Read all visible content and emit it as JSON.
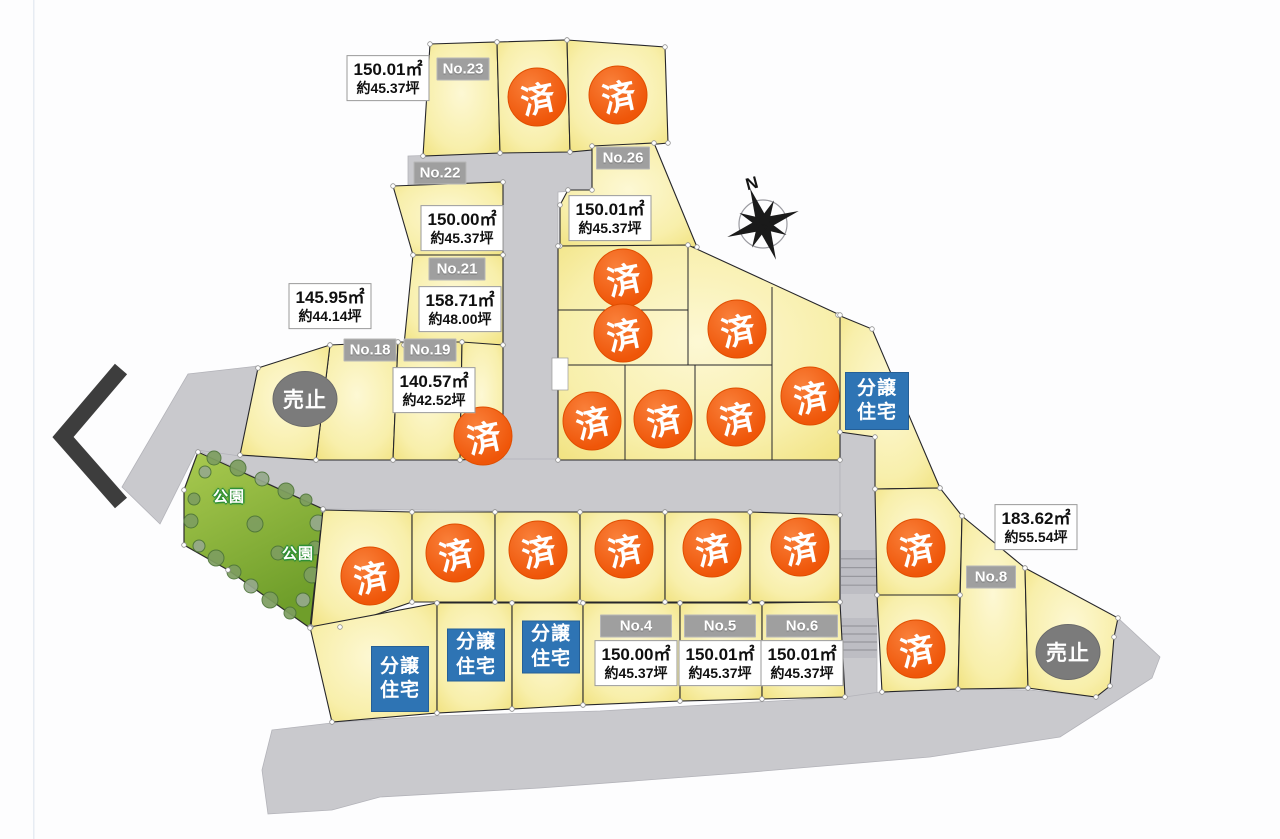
{
  "compass": {
    "label": "N",
    "x": 752,
    "y": 184
  },
  "park": {
    "labels": [
      {
        "text": "公園",
        "x": 229,
        "y": 496
      },
      {
        "text": "公園",
        "x": 298,
        "y": 553
      }
    ]
  },
  "markers": {
    "sold": {
      "label": "済",
      "color": "#f15b12",
      "positions": [
        {
          "x": 537,
          "y": 97
        },
        {
          "x": 618,
          "y": 95
        },
        {
          "x": 623,
          "y": 278
        },
        {
          "x": 623,
          "y": 333
        },
        {
          "x": 737,
          "y": 329
        },
        {
          "x": 592,
          "y": 421
        },
        {
          "x": 663,
          "y": 419
        },
        {
          "x": 736,
          "y": 417
        },
        {
          "x": 810,
          "y": 396
        },
        {
          "x": 483,
          "y": 436
        },
        {
          "x": 370,
          "y": 576
        },
        {
          "x": 455,
          "y": 553
        },
        {
          "x": 538,
          "y": 550
        },
        {
          "x": 624,
          "y": 549
        },
        {
          "x": 712,
          "y": 548
        },
        {
          "x": 800,
          "y": 547
        },
        {
          "x": 916,
          "y": 548
        },
        {
          "x": 916,
          "y": 649
        }
      ]
    },
    "sales_stopped": {
      "label": "売止",
      "color": "#7b7b7b",
      "positions": [
        {
          "x": 305,
          "y": 399
        },
        {
          "x": 1068,
          "y": 652
        }
      ]
    },
    "built_house": {
      "lines": [
        "分譲",
        "住宅"
      ],
      "color": "#2e74b4",
      "positions": [
        {
          "x": 877,
          "y": 401,
          "w": 62,
          "h": 56
        },
        {
          "x": 400,
          "y": 679,
          "w": 56,
          "h": 64
        },
        {
          "x": 476,
          "y": 655,
          "w": 56,
          "h": 51
        },
        {
          "x": 551,
          "y": 647,
          "w": 56,
          "h": 51
        }
      ]
    }
  },
  "lot_tags": [
    {
      "text": "No.23",
      "x": 463,
      "y": 69,
      "w": 53
    },
    {
      "text": "No.22",
      "x": 440,
      "y": 173,
      "w": 53
    },
    {
      "text": "No.26",
      "x": 623,
      "y": 158,
      "w": 54
    },
    {
      "text": "No.21",
      "x": 457,
      "y": 269,
      "w": 57
    },
    {
      "text": "No.18",
      "x": 370,
      "y": 350,
      "w": 53
    },
    {
      "text": "No.19",
      "x": 430,
      "y": 350,
      "w": 53
    },
    {
      "text": "No.4",
      "x": 636,
      "y": 626,
      "w": 72
    },
    {
      "text": "No.5",
      "x": 720,
      "y": 626,
      "w": 72
    },
    {
      "text": "No.6",
      "x": 802,
      "y": 626,
      "w": 72
    },
    {
      "text": "No.8",
      "x": 991,
      "y": 577,
      "w": 50
    }
  ],
  "area_labels": [
    {
      "sqm": "150.01㎡",
      "tsubo": "約45.37坪",
      "x": 388,
      "y": 78
    },
    {
      "sqm": "150.00㎡",
      "tsubo": "約45.37坪",
      "x": 462,
      "y": 228
    },
    {
      "sqm": "150.01㎡",
      "tsubo": "約45.37坪",
      "x": 610,
      "y": 218
    },
    {
      "sqm": "158.71㎡",
      "tsubo": "約48.00坪",
      "x": 460,
      "y": 309
    },
    {
      "sqm": "145.95㎡",
      "tsubo": "約44.14坪",
      "x": 330,
      "y": 306
    },
    {
      "sqm": "140.57㎡",
      "tsubo": "約42.52坪",
      "x": 434,
      "y": 390
    },
    {
      "sqm": "183.62㎡",
      "tsubo": "約55.54坪",
      "x": 1036,
      "y": 527
    },
    {
      "sqm": "150.00㎡",
      "tsubo": "約45.37坪",
      "x": 636,
      "y": 663
    },
    {
      "sqm": "150.01㎡",
      "tsubo": "約45.37坪",
      "x": 720,
      "y": 663
    },
    {
      "sqm": "150.01㎡",
      "tsubo": "約45.37坪",
      "x": 802,
      "y": 663
    }
  ],
  "colors": {
    "lot_fill_center": "#fdf8d4",
    "lot_fill_edge": "#f1e27f",
    "lot_outline": "#26262a",
    "road": "#c9c9cd",
    "park_top": "#a9ca50",
    "park_bottom": "#6f9e2a",
    "bush": "#7e9e60",
    "bush_alt": "#96a98c",
    "chevron": "#3d3d3d"
  }
}
